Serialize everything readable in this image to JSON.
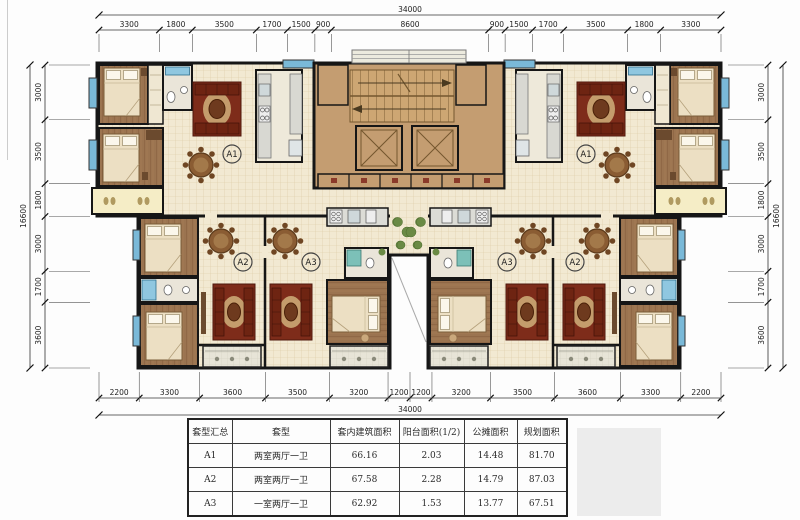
{
  "dimensions": {
    "top_total": "34000",
    "top": [
      "3300",
      "1800",
      "3500",
      "1700",
      "1500",
      "900",
      "8600",
      "900",
      "1500",
      "1700",
      "3500",
      "1800",
      "3300"
    ],
    "bottom": [
      "2200",
      "3300",
      "3600",
      "3500",
      "3200",
      "1200",
      "1200",
      "3200",
      "3500",
      "3600",
      "3300",
      "2200"
    ],
    "bottom_total": "34000",
    "left_total": "16600",
    "left": [
      "3000",
      "3500",
      "1800",
      "3000",
      "1700",
      "3600"
    ],
    "right": [
      "3000",
      "3500",
      "1800",
      "3000",
      "1700",
      "3600"
    ],
    "right_total": "16600"
  },
  "units": {
    "a1": "A1",
    "a2": "A2",
    "a3": "A3"
  },
  "table": {
    "headers": [
      "套型汇总",
      "套型",
      "套内建筑面积",
      "阳台面积(1/2)",
      "公摊面积",
      "规划面积"
    ],
    "rows": [
      [
        "A1",
        "两室两厅一卫",
        "66.16",
        "2.03",
        "14.48",
        "81.70"
      ],
      [
        "A2",
        "两室两厅一卫",
        "67.58",
        "2.28",
        "14.79",
        "87.03"
      ],
      [
        "A3",
        "一室两厅一卫",
        "62.92",
        "1.53",
        "13.77",
        "67.51"
      ]
    ]
  },
  "colors": {
    "wall": "#161616",
    "tile_floor": "#f2e9d2",
    "wood_floor": "#9b7450",
    "core": "#c49d71",
    "balcony": "#e7e4d7",
    "corner_balcony": "#f5edc6",
    "window_blue": "#7ab9d8",
    "sofa_red": "#7e2c1a",
    "rug_tan": "#c49c6c",
    "dining_table": "#8a5c33",
    "plant_green": "#6a8a45"
  }
}
